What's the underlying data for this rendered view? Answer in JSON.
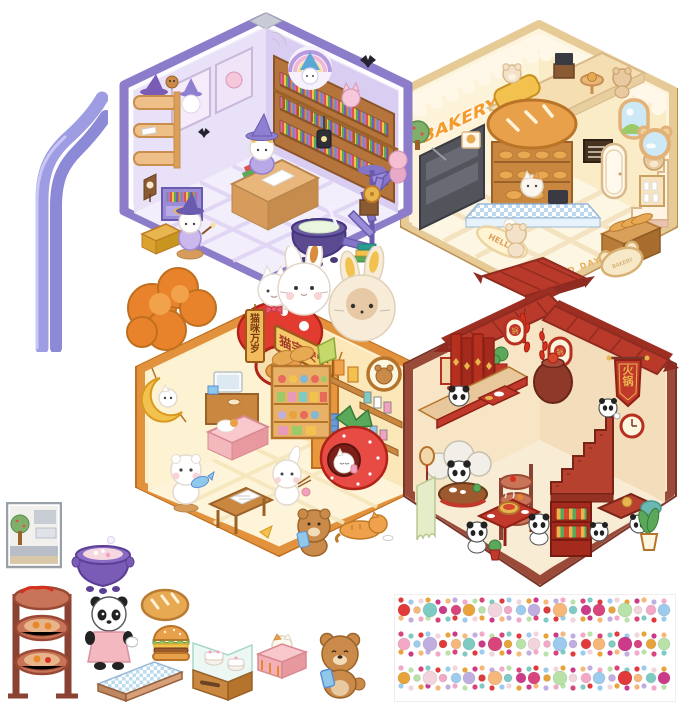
{
  "product": {
    "name": "DIY 3D cute cartoon sticker book scene set",
    "scenes": [
      "magic library",
      "bakery",
      "cat store",
      "panda hot pot restaurant"
    ]
  },
  "tweezers": {
    "label": "curved craft tweezers",
    "color": "#9e9ce2"
  },
  "rooms": {
    "library": {
      "label": "magic library room sticker",
      "border_color": "#8d7cc9"
    },
    "bakery": {
      "label": "bakery room sticker",
      "border_color": "#e7cb96",
      "sign_text": "BAKERY",
      "mat_text": "HELLO",
      "floor_text": "GOOD DAY",
      "rug_text": "BAKERY"
    },
    "cat_store": {
      "label": "cat store room sticker",
      "border_color": "#e2913c",
      "banner_text": "猫宅安宁",
      "side_sign_text": "猫咪万岁"
    },
    "hotpot": {
      "label": "panda hot pot restaurant room sticker",
      "border_color": "#9a4a38",
      "flag_text": "火锅",
      "window_decal_text": "锅"
    }
  },
  "mini_stickers": {
    "items": [
      "kitchen window picture",
      "purple soup pot",
      "steamer rack tower",
      "panda waitress",
      "bread loaf",
      "hamburger",
      "checkered counter",
      "cake display case",
      "cat tissue box",
      "bear with phone"
    ]
  },
  "gem_sheet": {
    "label": "rhinestone sticker strips",
    "strips": 3,
    "colors": [
      "#e03a3a",
      "#d8447c",
      "#f4a8c8",
      "#f5b87a",
      "#e8a43a",
      "#9ccbee",
      "#7ecbc4",
      "#b8e2a8",
      "#c0aee0",
      "#cc3a8a",
      "#f2d4dc"
    ]
  }
}
